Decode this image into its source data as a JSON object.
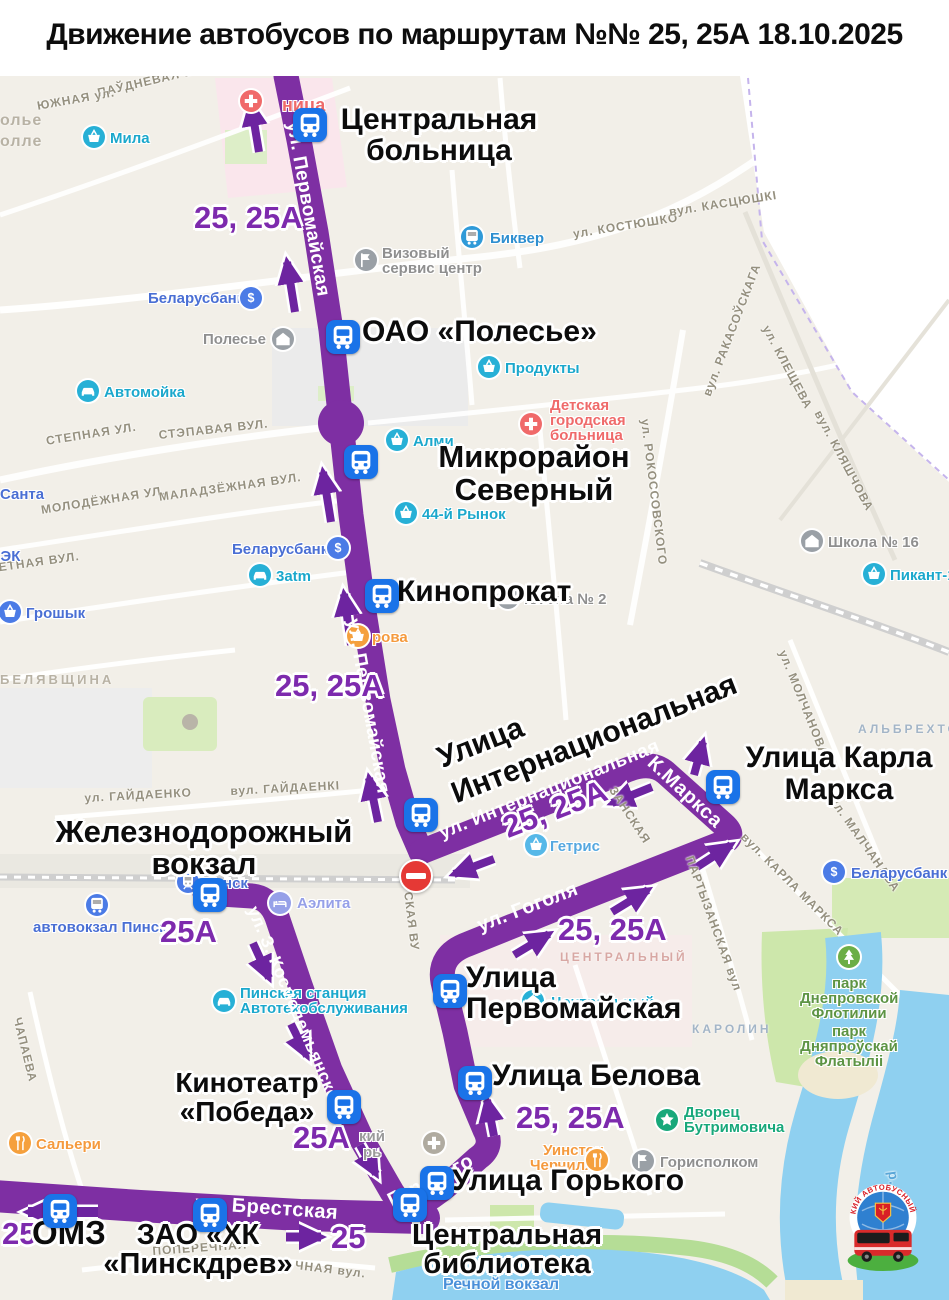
{
  "title": "Движение автобусов по маршрутам №№ 25, 25А 18.10.2025",
  "colors": {
    "route_purple": "#7e2fa3",
    "arrow_purple": "#6d24a0",
    "stop_icon_blue": "#1a73e8",
    "no_entry_red": "#e53935"
  },
  "stops": [
    {
      "l1": "Центральная",
      "l2": "больница"
    },
    {
      "l1": "ОАО «Полесье»"
    },
    {
      "l1": "Микрорайон",
      "l2": "Северный"
    },
    {
      "l1": "Кинопрокат"
    },
    {
      "l1": "Улица",
      "l2": "Интернациональная"
    },
    {
      "l1": "Улица Карла",
      "l2": "Маркса"
    },
    {
      "l1": "Железнодорожный",
      "l2": "вокзал"
    },
    {
      "l1": "Улица",
      "l2": "Первомайская"
    },
    {
      "l1": "Улица Белова"
    },
    {
      "l1": "Кинотеатр",
      "l2": "«Победа»"
    },
    {
      "l1": "Улица Горького"
    },
    {
      "l1": "Центральная",
      "l2": "библиотека"
    },
    {
      "l1": "ОМЗ"
    },
    {
      "l1": "ЗАО «ХК",
      "l2": "«Пинскдрев»"
    }
  ],
  "route_labels": [
    {
      "text": "25, 25А"
    },
    {
      "text": "25, 25А"
    },
    {
      "text": "25, 25А"
    },
    {
      "text": "25, 25А"
    },
    {
      "text": "25, 25А"
    },
    {
      "text": "25А"
    },
    {
      "text": "25А"
    },
    {
      "text": "25"
    },
    {
      "text": "25"
    }
  ],
  "banners": [
    {
      "text": "ул. Первомайская"
    },
    {
      "text": "ул. Первомайская"
    },
    {
      "text": "ул. Интернациональная"
    },
    {
      "text": "К.Маркса"
    },
    {
      "text": "ул. Гоголя"
    },
    {
      "text": "ул. З. Космодемьянской"
    },
    {
      "text": "Горького"
    },
    {
      "text": "ул. Брестская"
    }
  ],
  "pois": [
    {
      "l1": "Мила"
    },
    {
      "l1": "Биквер"
    },
    {
      "l1": "Визовый",
      "l2": "сервис центр"
    },
    {
      "l1": "Беларусбанк"
    },
    {
      "l1": "Полесье"
    },
    {
      "l1": "Продукты"
    },
    {
      "l1": "Автомойка"
    },
    {
      "l1": "Детская",
      "l2": "городская",
      "l3": "больница"
    },
    {
      "l1": "Алми"
    },
    {
      "l1": "44-й Рынок"
    },
    {
      "l1": "Школа № 16"
    },
    {
      "l1": "Пикант-1"
    },
    {
      "l1": "Санта"
    },
    {
      "l1": "ЛЭК"
    },
    {
      "l1": "Грошык"
    },
    {
      "l1": "3atm"
    },
    {
      "l1": "Беларусбанк"
    },
    {
      "l1": "Школа № 2"
    },
    {
      "l1": "рова"
    },
    {
      "l1": "Гетрис"
    },
    {
      "l1": "Пинск"
    },
    {
      "l1": "автовокзал Пинск"
    },
    {
      "l1": "Аэлита"
    },
    {
      "l1": "Пинская станция",
      "l2": "Автотехобслуживания"
    },
    {
      "l1": "Уинстон",
      "l2": "Черчилль"
    },
    {
      "l1": "Горисполком"
    },
    {
      "l1": "Дворец",
      "l2": "Бутримовича"
    },
    {
      "l1": "Речной вокзал"
    },
    {
      "l1": "Сальери"
    },
    {
      "l1": "парк",
      "l2": "Днепровской",
      "l3": "Флотилии"
    },
    {
      "l1": "парк",
      "l2": "Дняпроўскай",
      "l3": "Флатыліі"
    },
    {
      "l1": "Центральный"
    },
    {
      "l1": "Беларусбанк"
    },
    {
      "l1": "ница"
    },
    {
      "l1": "кий",
      "l2": "рь"
    }
  ],
  "streets": [
    {
      "text": "ПАЎДНЕВАЯ ВУЛ."
    },
    {
      "text": "ЮЖНАЯ ул."
    },
    {
      "text": "ул. КОСТЮШКО"
    },
    {
      "text": "вул. КАСЦЮШКІ"
    },
    {
      "text": "СТЕПНАЯ УЛ."
    },
    {
      "text": "СТЭПАВАЯ ВУЛ."
    },
    {
      "text": "МОЛОДЁЖНАЯ УЛ."
    },
    {
      "text": "МАЛАДЗЁЖНАЯ ВУЛ."
    },
    {
      "text": "РАКЕТНАЯ ВУЛ."
    },
    {
      "text": "ул. РОКОССОВСКОГО"
    },
    {
      "text": "вул. РАКАСОЎСКАГА"
    },
    {
      "text": "ул. КЛЕЩЕВА"
    },
    {
      "text": "вул. КЛЯШЧОВА"
    },
    {
      "text": "ул. МОЛЧАНОВА"
    },
    {
      "text": "вул. МАЛЧАНАВА"
    },
    {
      "text": "ул. ГАЙДАЕНКО"
    },
    {
      "text": "вул. ГАЙДАЕНКІ"
    },
    {
      "text": "вул. КАРЛА МАРКСА"
    },
    {
      "text": "ПАРТЫЗАНСКАЯ вул"
    },
    {
      "text": "ЗАНСКАЯ"
    },
    {
      "text": "ПОПЕРЕЧНАЯ"
    },
    {
      "text": "ЧНАЯ вул."
    },
    {
      "text": "ЧАПАЕВА"
    },
    {
      "text": "р. Прыпять"
    },
    {
      "text": "СКАЯ ВУ"
    }
  ],
  "districts": [
    {
      "text": "олье"
    },
    {
      "text": "олле"
    },
    {
      "text": "БЕЛЯВЩИНА"
    },
    {
      "text": "ЦЕНТРАЛЬНЫЙ"
    },
    {
      "text": "КАРОЛИН"
    },
    {
      "text": "АЛЬБРЕХТОВО"
    }
  ],
  "logo": {
    "ring_text": "ПИНСКИЙ АВТОБУСНЫЙ ПАРК"
  }
}
